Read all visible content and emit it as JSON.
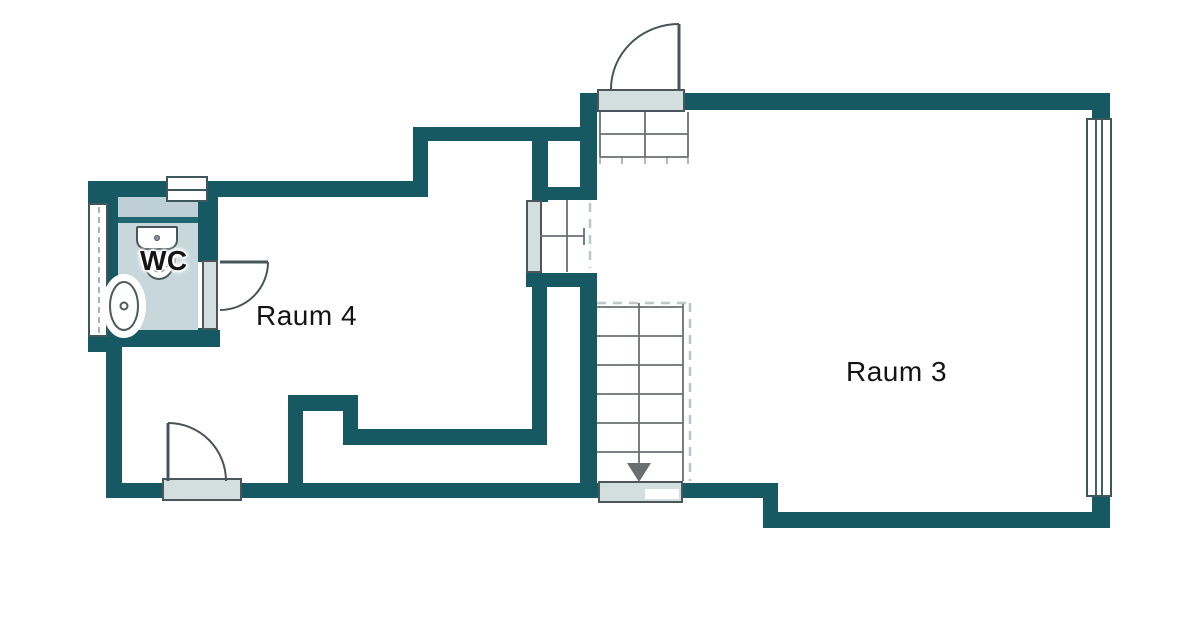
{
  "title": "Grundriss Obergeschoss",
  "labels": {
    "room3": "Raum 3",
    "room4": "Raum 4",
    "wc": "WC"
  },
  "colors": {
    "wall": "#175963",
    "room_fill": "#c7d7db",
    "room_fill_dark": "#becfd5",
    "divider": "#206671",
    "threshold_fill": "#d3dedf",
    "threshold_border": "#4a565b",
    "door_line": "#475559",
    "stair_line": "#6a6f72",
    "dash": "#bcc7ca",
    "text": "#141414",
    "background": "#ffffff"
  },
  "elements": {
    "doors": [
      "entrance-door",
      "wc-door",
      "room4-door"
    ],
    "windows": [
      "left-window",
      "wc-window",
      "room3-window"
    ],
    "stairs": [
      "entry-steps",
      "stair-landing",
      "main-staircase-down"
    ],
    "fixtures": [
      "sink",
      "toilet"
    ]
  }
}
